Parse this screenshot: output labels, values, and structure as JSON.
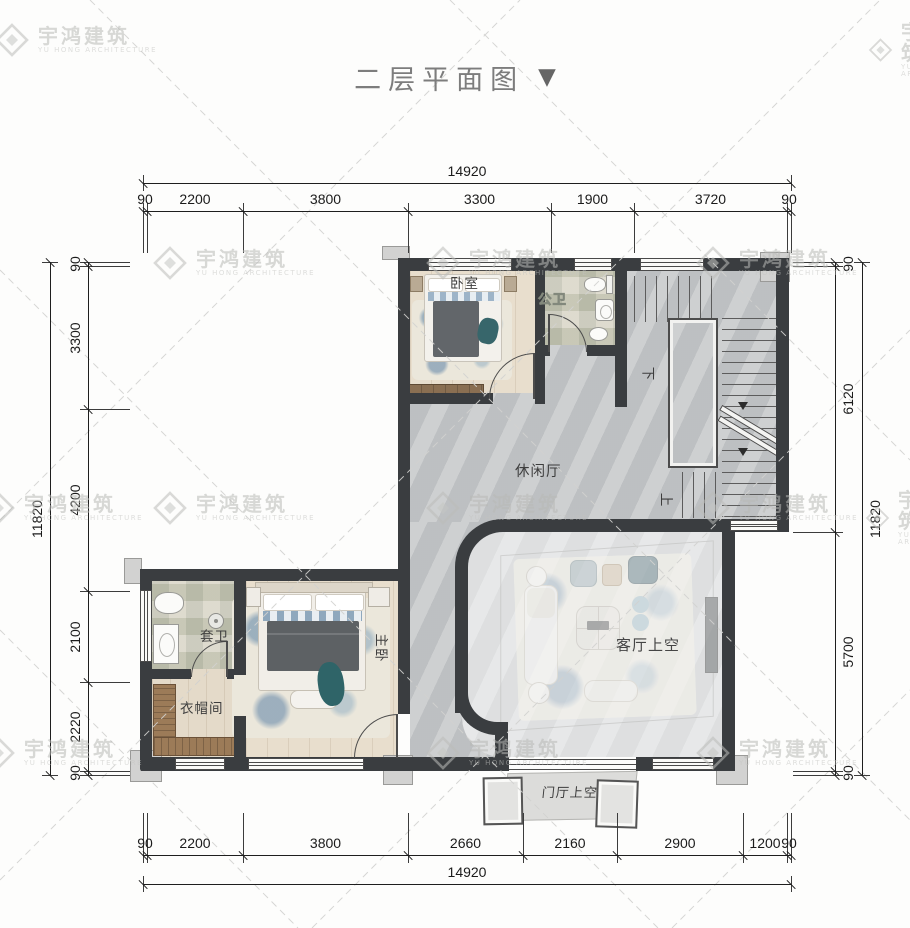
{
  "title": {
    "text": "二层平面图",
    "dropdown_icon": "▼"
  },
  "watermark": {
    "cn": "宇鸿建筑",
    "en": "YU HONG ARCHITECTURE"
  },
  "dimensions": {
    "top": {
      "total": "14920",
      "segments": [
        "90",
        "2200",
        "3800",
        "3300",
        "1900",
        "3720",
        "90"
      ]
    },
    "bottom": {
      "total": "14920",
      "segments": [
        "90",
        "2200",
        "3800",
        "2660",
        "2160",
        "2900",
        "1200",
        "90"
      ]
    },
    "left": {
      "total": "11820",
      "segments": [
        "90",
        "3300",
        "4200",
        "2100",
        "2220",
        "90"
      ]
    },
    "right": {
      "total": "11820",
      "segments": [
        "90",
        "6120",
        "5700",
        "90"
      ]
    }
  },
  "rooms": {
    "bedroom": "卧室",
    "public_bath": "公卫",
    "leisure_hall": "休闲厅",
    "ensuite_bath": "套卫",
    "master_bedroom": "主卧",
    "cloakroom": "衣帽间",
    "living_room_void": "客厅上空",
    "foyer_void": "门厅上空",
    "stair_down": "下",
    "stair_up": "上"
  },
  "colors": {
    "wall": "#3a3d40",
    "hall_tile": "#c6c8ca",
    "void_tile": "#d7d9da",
    "wood_floor": "#e8decd",
    "accent_teal": "#336a6e",
    "dim_text": "#1b1b1b",
    "watermark": "#b9bab7",
    "title_text": "#7d7d7d"
  }
}
